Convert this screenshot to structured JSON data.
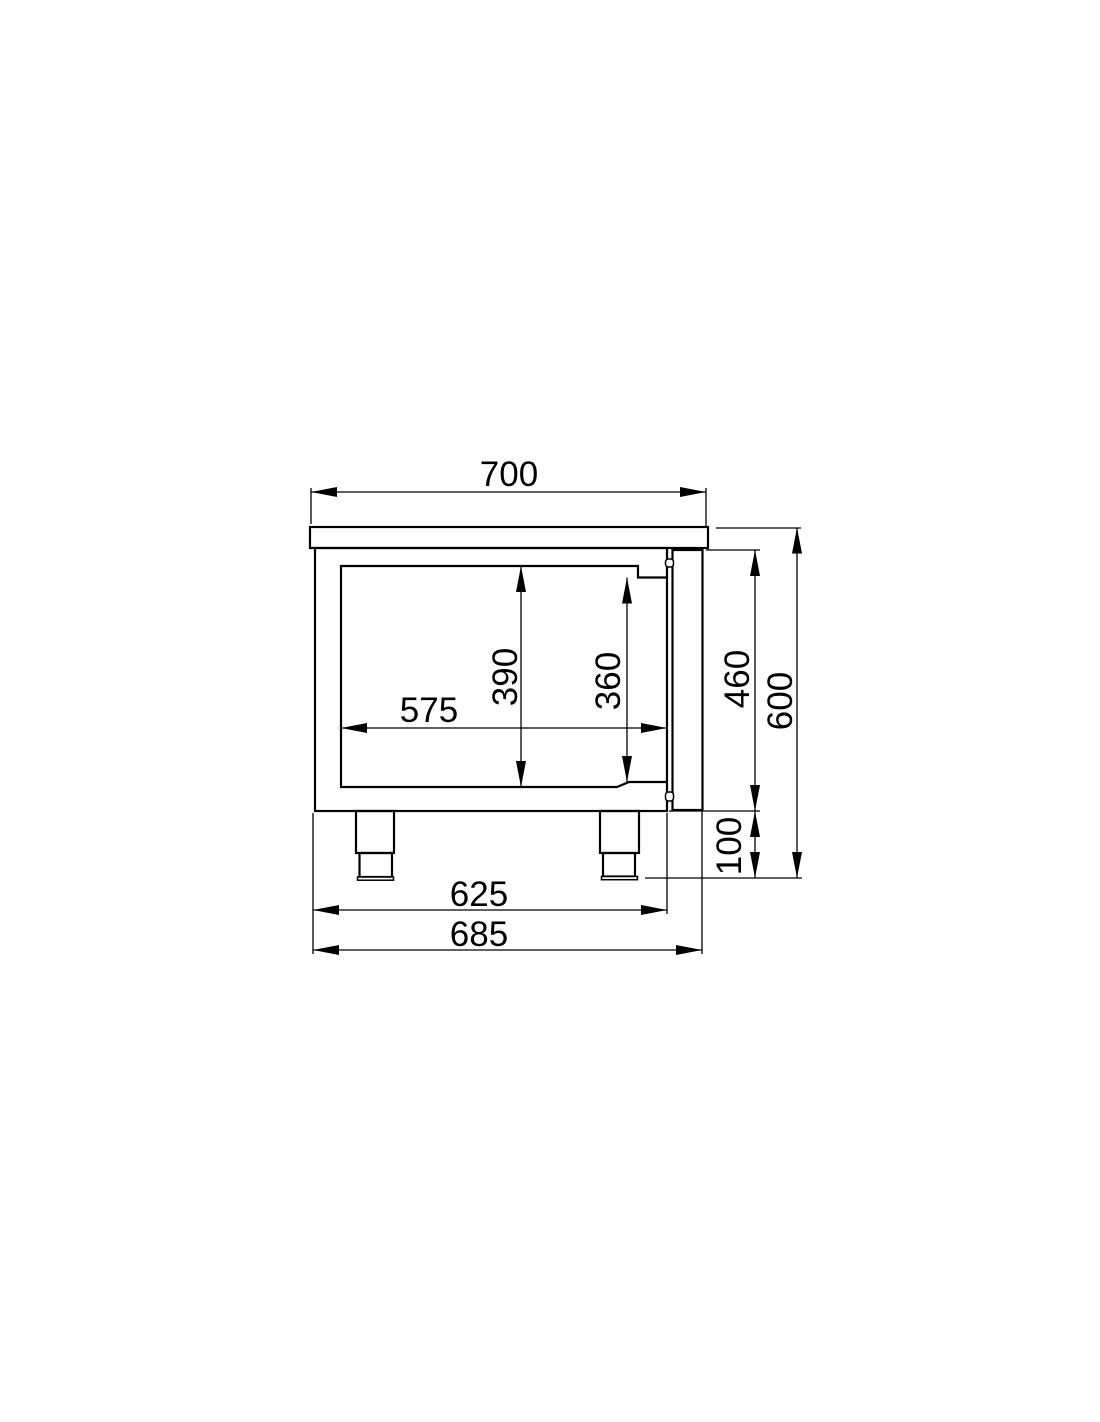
{
  "drawing": {
    "kind": "technical-dimension-drawing",
    "view": "side-section",
    "units": "mm",
    "colors": {
      "line": "#000000",
      "background": "#ffffff",
      "text": "#000000"
    },
    "dimensions": {
      "top_depth": "700",
      "inner_depth": "575",
      "inner_height": "390",
      "inner_height_right": "360",
      "body_height": "460",
      "total_height": "600",
      "leg_height": "100",
      "base_depth_inner": "625",
      "base_depth_outer": "685"
    }
  }
}
